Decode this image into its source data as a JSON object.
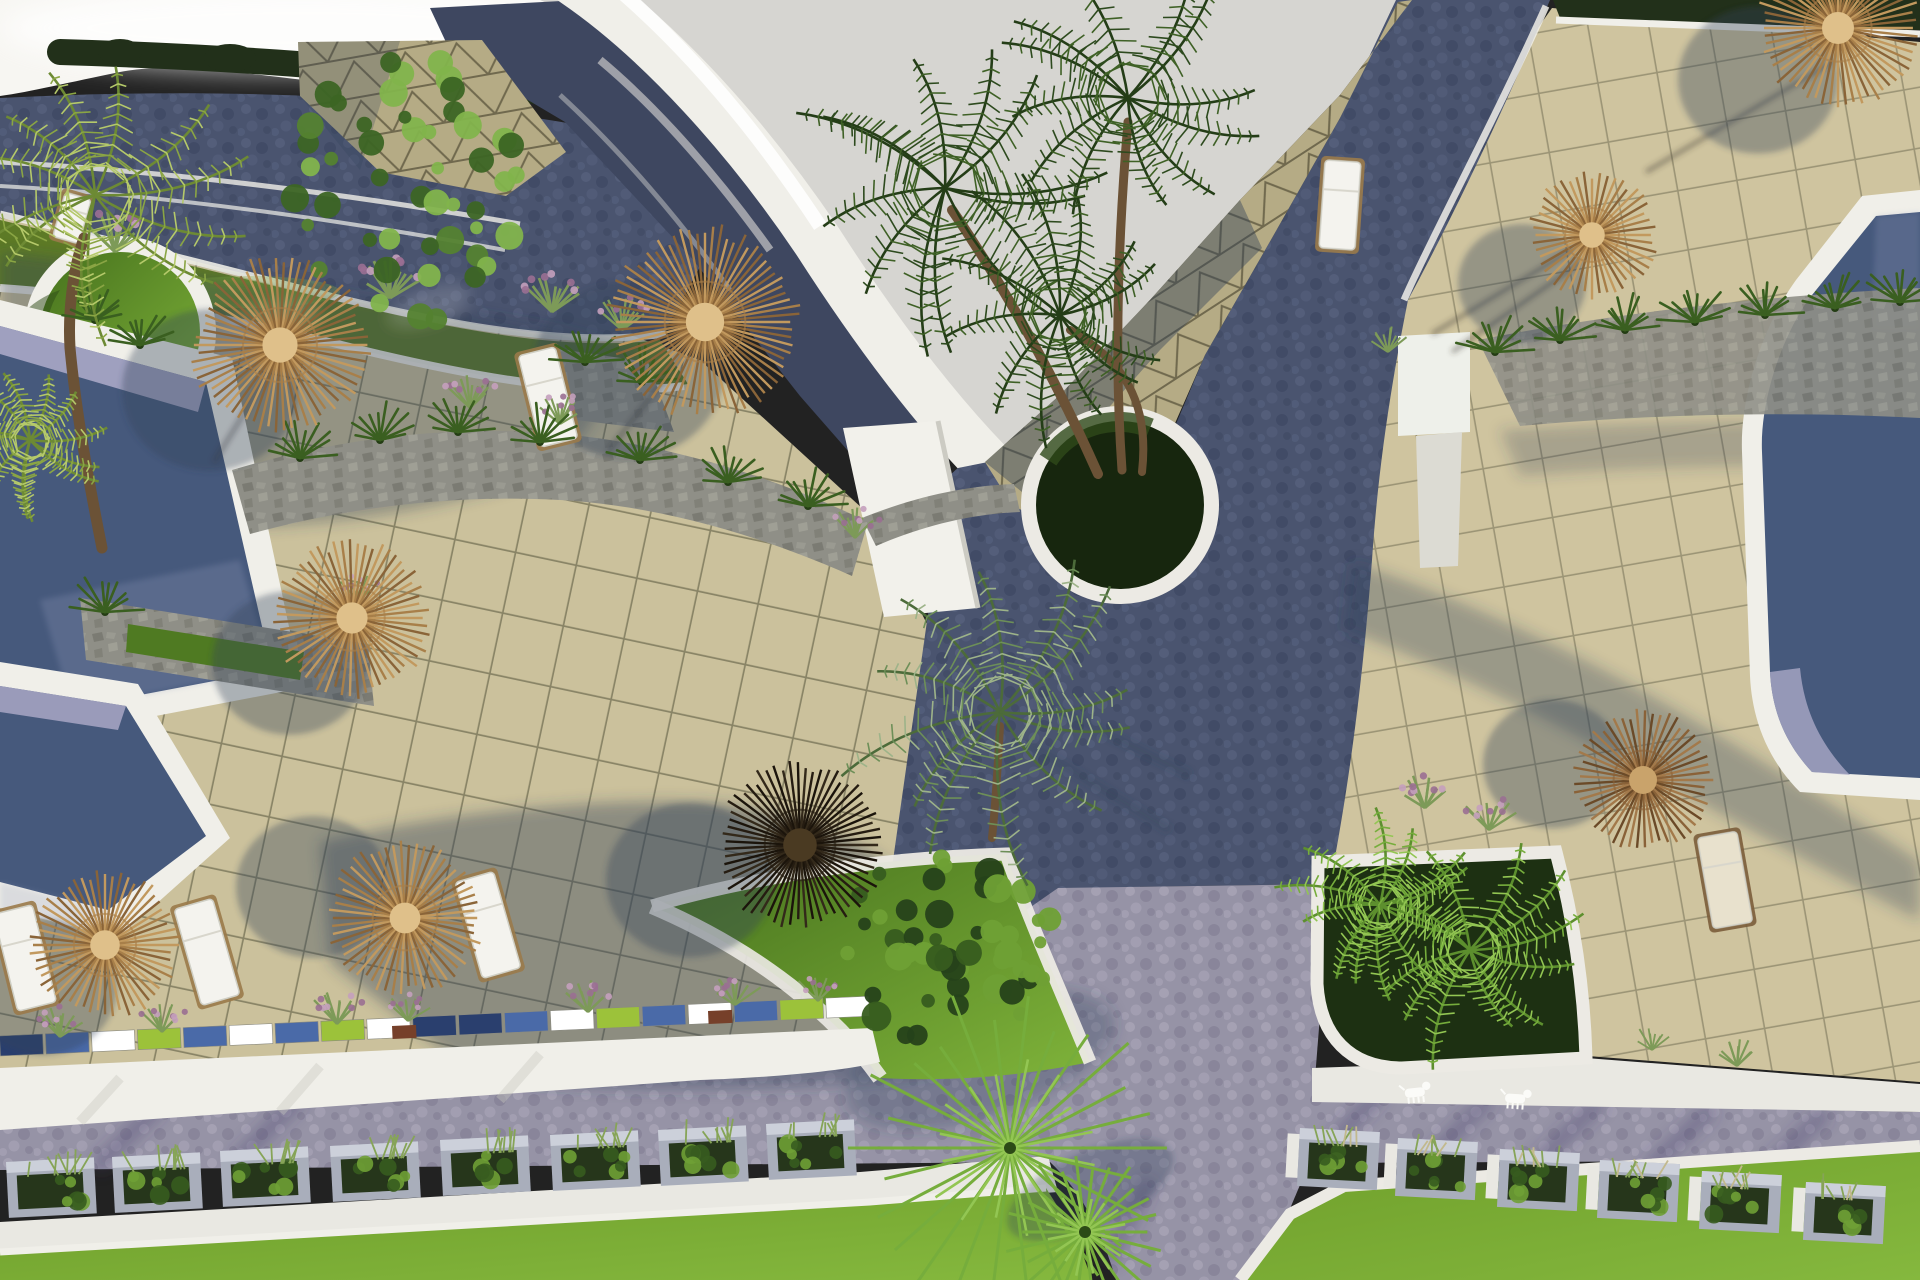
{
  "scene": {
    "description": "Aerial top-down 3D architectural rendering of a resort pool terrace with thatched umbrellas, sun loungers, palm trees, planters, cobbled roads and lawns",
    "view": "top-down-aerial",
    "render_style": "photoreal-3d"
  },
  "palette": {
    "sky": "#d6d5d1",
    "white": "#f0efe9",
    "patio": "#cbc19c",
    "gridLine": "#51513b",
    "tri": "#b5ab85",
    "triLine": "#5f5940",
    "roof": "#3e4760",
    "roadDark": "#4a546f",
    "roadDarkDot1": "#5d6886",
    "roadDarkDot2": "#3b4560",
    "roadLight": "#9693a6",
    "roadLightDot1": "#b3b0c0",
    "roadLightDot2": "#7d7a90",
    "hedge": "#22301a",
    "verge": "#5d7a26",
    "lawn": "#6f9f2b",
    "lawnLight": "#85b83e",
    "planterLawn": "#4f7a22",
    "pool": "#46597c",
    "poolEdge": "#a9a7c6",
    "poolLight": "#8e97b8",
    "stone": "#8f8f87",
    "stoneDark": "#6e6e66",
    "fan": "#76ad3c",
    "fanLight": "#93c653",
    "fern": "#3a5f20",
    "bushLight": "#6fa035",
    "flower": "#c4a0bd",
    "flowerDeep": "#9a6f92",
    "stem": "#7d9a58",
    "wood": "#9a7a4a",
    "woodDark": "#7a5c3a",
    "trunk": "#6b5236",
    "boxGray": "#a9aebb",
    "boxLight": "#ccd0da",
    "plantDark": "#26361b",
    "grass": "#86a457",
    "grassDry": "#c2b98e",
    "shadow": "#2f4158",
    "walk": "#e9e8e2",
    "dog": "#fbfbf8",
    "mosaic": [
      "#2a3f6e",
      "#4a6aa8",
      "#ffffff",
      "#9cc23a",
      "#4a6aa8",
      "#ffffff",
      "#4a6aa8",
      "#9cc23a",
      "#ffffff",
      "#2a3f6e"
    ],
    "umbTan": [
      "#c2995e",
      "#a87f49",
      "#8a6438",
      "#dfc08a"
    ],
    "umbBrown": [
      "#a3794a",
      "#8a6238",
      "#6b4a28",
      "#c9a36b"
    ],
    "umbDark": [
      "#33291a",
      "#251c11",
      "#1b140b",
      "#4a3a22"
    ]
  },
  "umbrellas": [
    {
      "x": 280,
      "y": 345,
      "r": 88,
      "tone": "tan",
      "s": [
        -70,
        45
      ]
    },
    {
      "x": 705,
      "y": 322,
      "r": 96,
      "tone": "tan",
      "s": [
        -77,
        48
      ]
    },
    {
      "x": 352,
      "y": 618,
      "r": 78,
      "tone": "tan",
      "s": [
        -62,
        45
      ]
    },
    {
      "x": 105,
      "y": 945,
      "r": 74,
      "tone": "tan",
      "s": [
        -62,
        42
      ]
    },
    {
      "x": 405,
      "y": 918,
      "r": 77,
      "tone": "tan",
      "s": [
        -92,
        -31
      ]
    },
    {
      "x": 800,
      "y": 845,
      "r": 84,
      "tone": "dark",
      "s": [
        -110,
        35
      ]
    },
    {
      "x": 1643,
      "y": 780,
      "r": 70,
      "tone": "brown",
      "s": [
        -90,
        -16
      ]
    },
    {
      "x": 1592,
      "y": 235,
      "r": 64,
      "tone": "tan",
      "s": [
        -70,
        48
      ]
    },
    {
      "x": 1838,
      "y": 28,
      "r": 80,
      "tone": "tan",
      "s": [
        -80,
        52
      ]
    }
  ],
  "loungers": [
    {
      "x": 72,
      "y": 218,
      "w": 27,
      "h": 46,
      "rot": 16,
      "style": "white"
    },
    {
      "x": 548,
      "y": 397,
      "w": 38,
      "h": 94,
      "rot": -14,
      "style": "white"
    },
    {
      "x": 25,
      "y": 958,
      "w": 40,
      "h": 100,
      "rot": -14,
      "style": "white"
    },
    {
      "x": 207,
      "y": 952,
      "w": 40,
      "h": 100,
      "rot": -16,
      "style": "white"
    },
    {
      "x": 488,
      "y": 925,
      "w": 40,
      "h": 100,
      "rot": -16,
      "style": "white"
    },
    {
      "x": 1340,
      "y": 205,
      "w": 36,
      "h": 88,
      "rot": 4,
      "style": "white"
    },
    {
      "x": 1725,
      "y": 880,
      "w": 40,
      "h": 92,
      "rot": -10,
      "style": "wood"
    }
  ],
  "planter_boxes": {
    "left": [
      {
        "x": 6,
        "y": 1162
      },
      {
        "x": 112,
        "y": 1157
      },
      {
        "x": 220,
        "y": 1151
      },
      {
        "x": 330,
        "y": 1146
      },
      {
        "x": 440,
        "y": 1140
      },
      {
        "x": 550,
        "y": 1135
      },
      {
        "x": 658,
        "y": 1130
      },
      {
        "x": 766,
        "y": 1124
      }
    ],
    "right": [
      {
        "x": 1300,
        "y": 1128
      },
      {
        "x": 1398,
        "y": 1138
      },
      {
        "x": 1500,
        "y": 1149
      },
      {
        "x": 1600,
        "y": 1160
      },
      {
        "x": 1702,
        "y": 1171
      },
      {
        "x": 1806,
        "y": 1182
      }
    ]
  },
  "mosaic_strip": {
    "x1": 0,
    "y1": 1046,
    "x2": 872,
    "y2": 1006,
    "h": 20,
    "segw": 46,
    "brown_blocks": [
      {
        "x": 392,
        "y": 1026
      },
      {
        "x": 708,
        "y": 1011
      }
    ]
  },
  "grass_tufts": [
    {
      "x": 115,
      "y": 252,
      "s": 1.6,
      "p": true
    },
    {
      "x": 390,
      "y": 298,
      "s": 1.6,
      "p": true
    },
    {
      "x": 552,
      "y": 312,
      "s": 1.5,
      "p": true
    },
    {
      "x": 622,
      "y": 330,
      "s": 1.3,
      "p": true
    },
    {
      "x": 470,
      "y": 408,
      "s": 1.3,
      "p": true
    },
    {
      "x": 560,
      "y": 424,
      "s": 1.2,
      "p": true
    },
    {
      "x": 855,
      "y": 538,
      "s": 1.2,
      "p": true
    },
    {
      "x": 60,
      "y": 1037,
      "s": 1.2,
      "p": true
    },
    {
      "x": 162,
      "y": 1032,
      "s": 1.2,
      "p": true
    },
    {
      "x": 337,
      "y": 1024,
      "s": 1.3,
      "p": true
    },
    {
      "x": 408,
      "y": 1021,
      "s": 1.1,
      "p": true
    },
    {
      "x": 588,
      "y": 1012,
      "s": 1.3,
      "p": true
    },
    {
      "x": 735,
      "y": 1005,
      "s": 1.2,
      "p": true
    },
    {
      "x": 818,
      "y": 1001,
      "s": 1.1,
      "p": true
    },
    {
      "x": 1425,
      "y": 808,
      "s": 1.4,
      "p": true
    },
    {
      "x": 1489,
      "y": 830,
      "s": 1.3,
      "p": true
    },
    {
      "x": 1737,
      "y": 1066,
      "s": 1.2,
      "p": false
    },
    {
      "x": 1652,
      "y": 1050,
      "s": 1.0,
      "p": false
    },
    {
      "x": 358,
      "y": 600,
      "s": 1.0,
      "p": true
    },
    {
      "x": 1388,
      "y": 352,
      "s": 1.1,
      "p": false
    }
  ],
  "ferns": [
    {
      "x": 300,
      "y": 458
    },
    {
      "x": 380,
      "y": 440
    },
    {
      "x": 458,
      "y": 432
    },
    {
      "x": 540,
      "y": 442
    },
    {
      "x": 640,
      "y": 460
    },
    {
      "x": 728,
      "y": 482
    },
    {
      "x": 808,
      "y": 506
    },
    {
      "x": 585,
      "y": 362
    },
    {
      "x": 642,
      "y": 382
    },
    {
      "x": 1495,
      "y": 352
    },
    {
      "x": 1560,
      "y": 340
    },
    {
      "x": 1625,
      "y": 330
    },
    {
      "x": 1695,
      "y": 322
    },
    {
      "x": 1765,
      "y": 315
    },
    {
      "x": 1835,
      "y": 308
    },
    {
      "x": 1900,
      "y": 302
    },
    {
      "x": 95,
      "y": 320
    },
    {
      "x": 140,
      "y": 345
    },
    {
      "x": 105,
      "y": 612
    }
  ],
  "blobs": [
    {
      "x": 405,
      "y": 190,
      "rx": 115,
      "ry": 135,
      "type": "tree"
    },
    {
      "x": 945,
      "y": 948,
      "rx": 115,
      "ry": 95,
      "type": "bush"
    }
  ],
  "canopies": [
    {
      "x": 945,
      "y": 188,
      "r": 168,
      "tone": "dark"
    },
    {
      "x": 1128,
      "y": 98,
      "r": 150,
      "tone": "dark"
    },
    {
      "x": 1060,
      "y": 315,
      "r": 142,
      "tone": "dark"
    },
    {
      "x": 95,
      "y": 195,
      "r": 150,
      "tone": "yellow"
    },
    {
      "x": 30,
      "y": 440,
      "r": 85,
      "tone": "yellow"
    },
    {
      "x": 1000,
      "y": 712,
      "r": 165,
      "tone": "silver"
    },
    {
      "x": 1380,
      "y": 905,
      "r": 100,
      "tone": "lime"
    },
    {
      "x": 1470,
      "y": 950,
      "r": 120,
      "tone": "lime"
    }
  ],
  "fan_palms": [
    {
      "x": 1010,
      "y": 1148,
      "r": 150
    },
    {
      "x": 1085,
      "y": 1232,
      "r": 75
    }
  ],
  "dogs": [
    {
      "x": 1415,
      "y": 1094,
      "rot": -6
    },
    {
      "x": 1515,
      "y": 1100,
      "rot": 4
    }
  ]
}
